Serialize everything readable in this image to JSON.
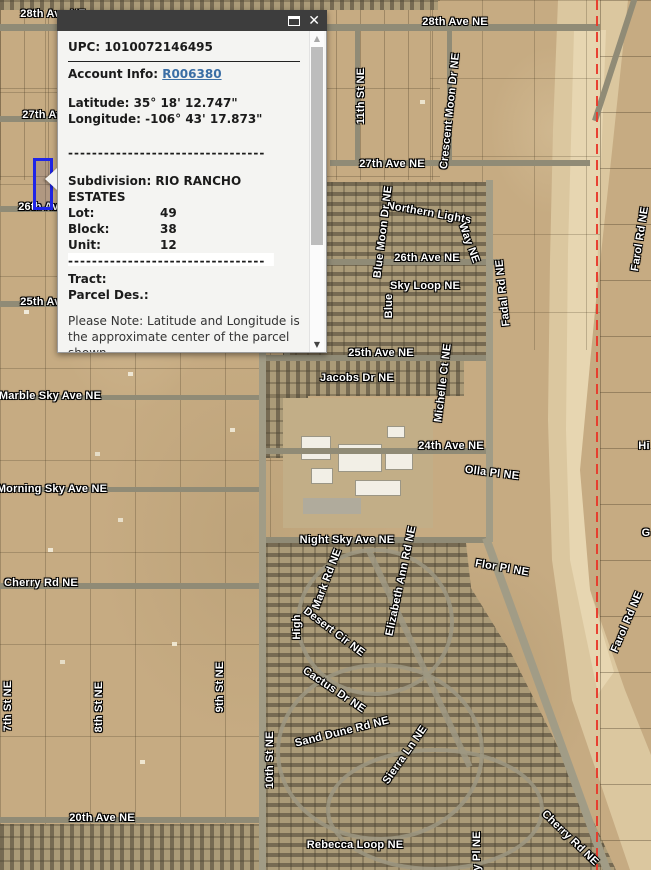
{
  "popup": {
    "titlebar": {
      "close_icon": "✕"
    },
    "upc": "UPC: 1010072146495",
    "account_label": "Account Info: ",
    "account_link": "R006380",
    "latitude": "Latitude: 35° 18' 12.747\"",
    "longitude": "Longitude: -106° 43' 17.873\"",
    "divider": "---------------------------------",
    "subdivision": "Subdivision: RIO RANCHO ESTATES",
    "fields": [
      {
        "label": "Lot:",
        "value": "49"
      },
      {
        "label": "Block:",
        "value": "38"
      },
      {
        "label": "Unit:",
        "value": "12"
      }
    ],
    "tract_label": "Tract:",
    "parcel_des_label": "Parcel Des.:",
    "note": "Please Note: Latitude and Longitude is the approximate center of the parcel shown.",
    "scrollbar": {
      "up_icon": "▲",
      "down_icon": "▼"
    }
  },
  "map": {
    "selected_parcel": {
      "x": 33,
      "y": 158,
      "width": 14,
      "height": 46,
      "border_color": "#1f25e8"
    },
    "boundary_line_color": "#e8392b",
    "labels": [
      {
        "text": "28th Ave NE",
        "x": 53,
        "y": 14,
        "rot": 0
      },
      {
        "text": "28th Ave NE",
        "x": 455,
        "y": 22,
        "rot": 0
      },
      {
        "text": "27th Ave NE",
        "x": 55,
        "y": 115,
        "rot": 0
      },
      {
        "text": "27th Ave NE",
        "x": 392,
        "y": 164,
        "rot": 0
      },
      {
        "text": "26th Ave NE",
        "x": 51,
        "y": 207,
        "rot": 0
      },
      {
        "text": "26th Ave NE",
        "x": 427,
        "y": 258,
        "rot": 0
      },
      {
        "text": "25th Ave NE",
        "x": 53,
        "y": 302,
        "rot": 0
      },
      {
        "text": "25th Ave NE",
        "x": 381,
        "y": 353,
        "rot": 0
      },
      {
        "text": "Northern Lights",
        "x": 429,
        "y": 213,
        "rot": 10
      },
      {
        "text": "Way NE",
        "x": 469,
        "y": 243,
        "rot": 70
      },
      {
        "text": "Blue Moon Dr NE",
        "x": 383,
        "y": 232,
        "rot": -83
      },
      {
        "text": "Sky Loop NE",
        "x": 425,
        "y": 286,
        "rot": 0
      },
      {
        "text": "Blue",
        "x": 389,
        "y": 306,
        "rot": -90
      },
      {
        "text": "11th St NE",
        "x": 361,
        "y": 96,
        "rot": -90
      },
      {
        "text": "Crescent Moon Dr NE",
        "x": 450,
        "y": 111,
        "rot": -84
      },
      {
        "text": "Fadal Rd NE",
        "x": 503,
        "y": 293,
        "rot": -96
      },
      {
        "text": "Farol Rd NE",
        "x": 640,
        "y": 239,
        "rot": -81
      },
      {
        "text": "Farol Rd NE",
        "x": 627,
        "y": 622,
        "rot": -67
      },
      {
        "text": "Jacobs Dr NE",
        "x": 357,
        "y": 378,
        "rot": 0
      },
      {
        "text": "Michelle Ct NE",
        "x": 443,
        "y": 383,
        "rot": -83
      },
      {
        "text": "24th Ave NE",
        "x": 451,
        "y": 446,
        "rot": 0
      },
      {
        "text": "Olla Pl NE",
        "x": 492,
        "y": 473,
        "rot": 7
      },
      {
        "text": "Night Sky Ave NE",
        "x": 347,
        "y": 540,
        "rot": 0
      },
      {
        "text": "Flor Pl NE",
        "x": 502,
        "y": 568,
        "rot": 10
      },
      {
        "text": "Marble Sky Ave NE",
        "x": 50,
        "y": 396,
        "rot": 0
      },
      {
        "text": "Morning Sky Ave NE",
        "x": 52,
        "y": 489,
        "rot": 0
      },
      {
        "text": "Cherry Rd NE",
        "x": 41,
        "y": 583,
        "rot": 0
      },
      {
        "text": "20th Ave NE",
        "x": 102,
        "y": 818,
        "rot": 0
      },
      {
        "text": "Rebecca Loop NE",
        "x": 355,
        "y": 845,
        "rot": 0
      },
      {
        "text": "7th St NE",
        "x": 8,
        "y": 706,
        "rot": -90
      },
      {
        "text": "8th St NE",
        "x": 99,
        "y": 707,
        "rot": -90
      },
      {
        "text": "9th St NE",
        "x": 220,
        "y": 687,
        "rot": -90
      },
      {
        "text": "10th St NE",
        "x": 270,
        "y": 760,
        "rot": -90
      },
      {
        "text": "Elizabeth Ann Rd NE",
        "x": 401,
        "y": 581,
        "rot": -78
      },
      {
        "text": "Mark Rd NE",
        "x": 327,
        "y": 579,
        "rot": -69
      },
      {
        "text": "High",
        "x": 297,
        "y": 627,
        "rot": -90
      },
      {
        "text": "Desert Cir NE",
        "x": 334,
        "y": 632,
        "rot": 37
      },
      {
        "text": "Cactus Dr NE",
        "x": 334,
        "y": 690,
        "rot": 34
      },
      {
        "text": "Sand Dune Rd NE",
        "x": 342,
        "y": 732,
        "rot": -14
      },
      {
        "text": "Sierra Ln NE",
        "x": 405,
        "y": 755,
        "rot": -55
      },
      {
        "text": "Cherry Rd NE",
        "x": 570,
        "y": 838,
        "rot": 44
      },
      {
        "text": "y Pl NE",
        "x": 477,
        "y": 851,
        "rot": -90
      },
      {
        "text": "Hi",
        "x": 644,
        "y": 446,
        "rot": 0
      },
      {
        "text": "G",
        "x": 646,
        "y": 533,
        "rot": 0
      }
    ]
  }
}
